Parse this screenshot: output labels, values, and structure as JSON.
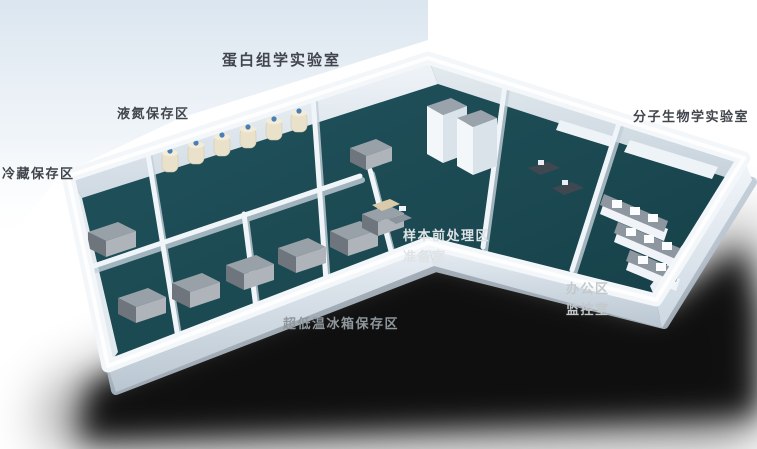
{
  "scene": {
    "description": "3D isometric floor plan of a biobank laboratory",
    "labels": {
      "proteomics_lab": {
        "text": "蛋白组学实验室",
        "color": "#41464c"
      },
      "liquid_nitrogen_area": {
        "text": "液氮保存区",
        "color": "#41464c"
      },
      "cold_storage_area": {
        "text": "冷藏保存区",
        "color": "#41464c"
      },
      "molecular_biology_lab": {
        "text": "分子生物学实验室",
        "color": "#41464c"
      },
      "sample_pretreatment_area": {
        "text": "样本前处理区",
        "color": "#dfe3e5"
      },
      "prep_room": {
        "text": "准备室",
        "color": "#dfe3e5"
      },
      "office_area": {
        "text": "办公区",
        "color": "#c3c8cb"
      },
      "monitoring_room": {
        "text": "监控室",
        "color": "#c3c8cb"
      },
      "ult_freezer_area": {
        "text": "超低温冰箱保存区",
        "color": "#8f979c"
      }
    },
    "colors": {
      "background": "#ffffff",
      "backdrop_blue": "#d9e4ee",
      "floor_teal": "#1c4a53",
      "wall_top": "#f3f7fa",
      "wall_shade": "#c3cfd9",
      "shadow": "#000000",
      "freezer_gray": "#99a1a8",
      "dewar_cream": "#e9e1c9",
      "dewar_cap_blue": "#4a7fb5",
      "bench_counter": "#8e979f",
      "desk_dark": "#3f4850"
    },
    "equipment": {
      "freezer_unit": "ultra-low temperature freezer",
      "nitrogen_dewar": "liquid nitrogen dewar tank",
      "storage_cabinet": "tall storage cabinet",
      "lab_bench": "laboratory bench with reagent shelf",
      "office_desk": "office workstation desk"
    }
  }
}
